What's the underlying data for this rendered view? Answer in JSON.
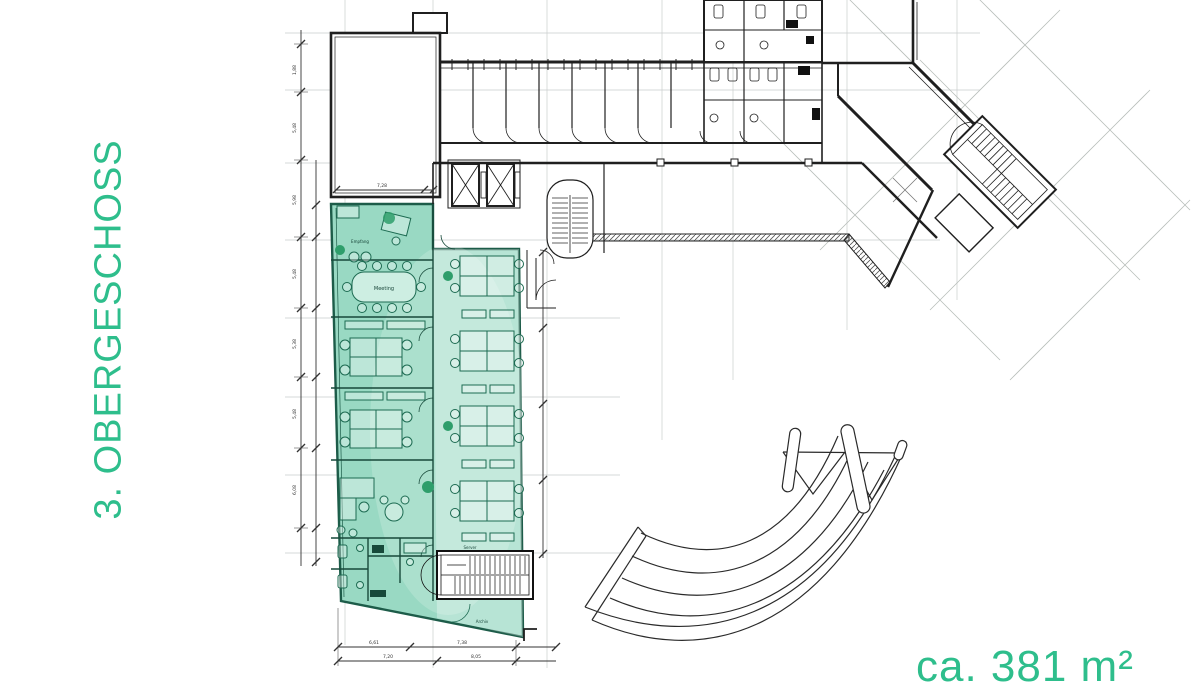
{
  "floor_label": {
    "text": "3. OBERGESCHOSS"
  },
  "area_label": {
    "text": "ca. 381 m²"
  },
  "colors": {
    "accent_green": "#2ebe8c",
    "highlight_teal": "#99d9c3",
    "highlight_light": "#c6eadd",
    "plan_line": "#1f1f1f",
    "furniture_green": "#1d6b52",
    "grid_gray": "#c9cdcc"
  },
  "plan": {
    "rooms": {
      "reception": "Empfang",
      "meeting": "Meeting",
      "server": "Server",
      "archive": "Archiv"
    },
    "dimensions": {
      "left": [
        "1,88",
        "5,48",
        "5,98",
        "5,48",
        "5,38",
        "5,48",
        "6,08"
      ],
      "top": "7,28",
      "bottom_upper": [
        "6,61",
        "7,38"
      ],
      "bottom_lower": [
        "7,20",
        "8,05"
      ]
    }
  }
}
